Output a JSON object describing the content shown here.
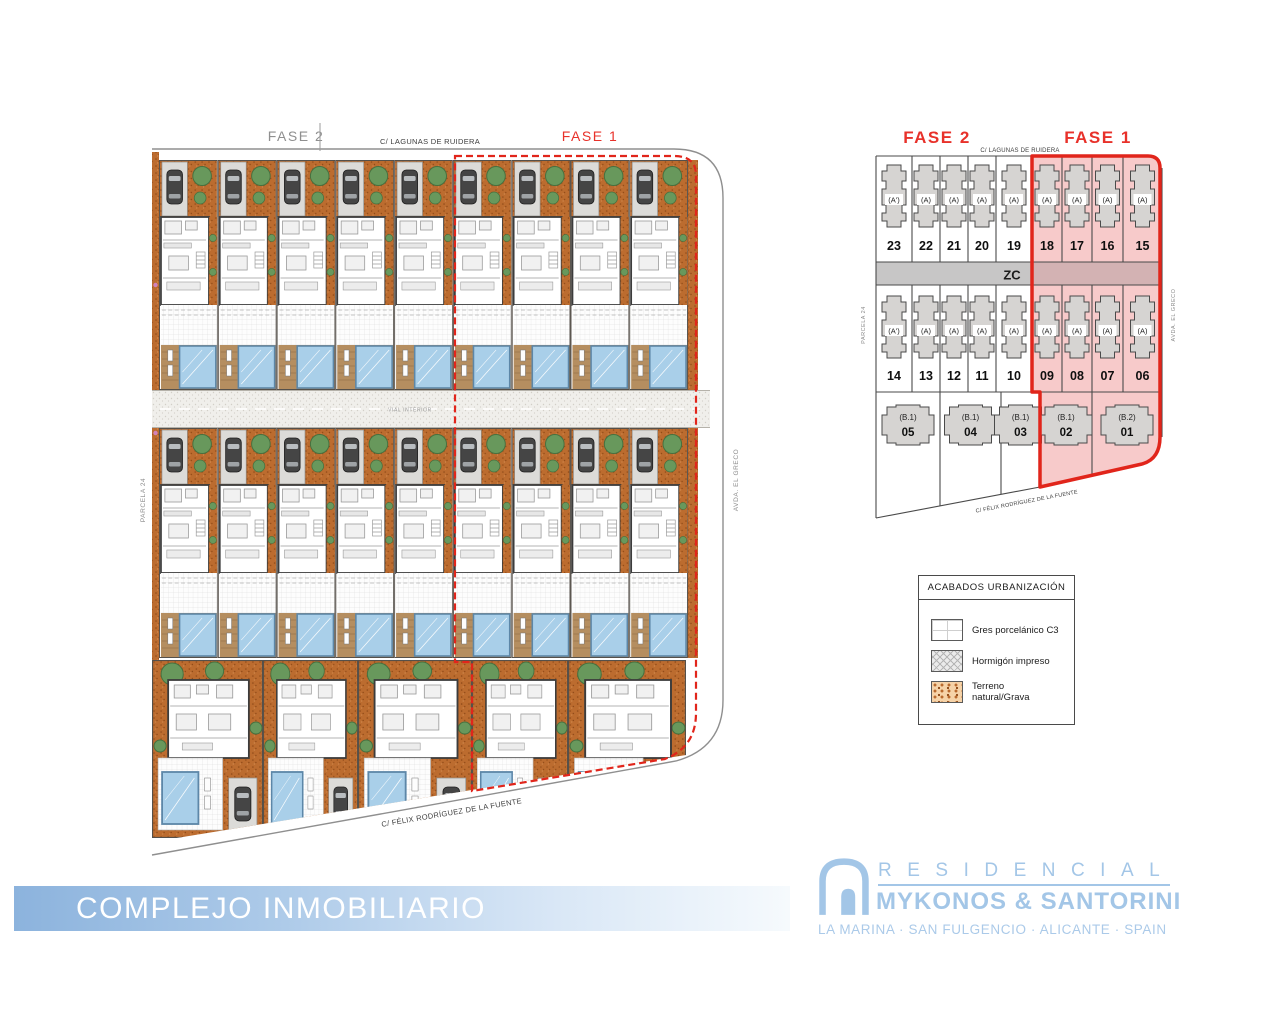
{
  "site_plan": {
    "fase2_label": "FASE 2",
    "fase1_label": "FASE 1",
    "street_top": "C/ LAGUNAS DE RUIDERA",
    "street_bottom": "C/ FÉLIX RODRÍGUEZ DE LA FUENTE",
    "street_right": "AVDA. EL GRECO",
    "parcel_left": "PARCELA 24",
    "road_interior": "VIAL INTERIOR"
  },
  "plot_diagram": {
    "fase2_label": "FASE 2",
    "fase1_label": "FASE 1",
    "street_top": "C/ LAGUNAS DE RUIDERA",
    "street_bottom": "C/ FÉLIX RODRÍGUEZ DE LA FUENTE",
    "street_right": "AVDA. EL GRECO",
    "parcel_left": "PARCELA 24",
    "zc_label": "ZC",
    "row1": [
      {
        "num": "23",
        "type": "(A')",
        "phase": "FASE 2"
      },
      {
        "num": "22",
        "type": "(A)",
        "phase": "FASE 2"
      },
      {
        "num": "21",
        "type": "(A)",
        "phase": "FASE 2"
      },
      {
        "num": "20",
        "type": "(A)",
        "phase": "FASE 2"
      },
      {
        "num": "19",
        "type": "(A)",
        "phase": "FASE 2"
      },
      {
        "num": "18",
        "type": "(A)",
        "phase": "FASE 1"
      },
      {
        "num": "17",
        "type": "(A)",
        "phase": "FASE 1"
      },
      {
        "num": "16",
        "type": "(A)",
        "phase": "FASE 1"
      },
      {
        "num": "15",
        "type": "(A)",
        "phase": "FASE 1"
      }
    ],
    "row2": [
      {
        "num": "14",
        "type": "(A')",
        "phase": "FASE 2"
      },
      {
        "num": "13",
        "type": "(A)",
        "phase": "FASE 2"
      },
      {
        "num": "12",
        "type": "(A)",
        "phase": "FASE 2"
      },
      {
        "num": "11",
        "type": "(A)",
        "phase": "FASE 2"
      },
      {
        "num": "10",
        "type": "(A)",
        "phase": "FASE 2"
      },
      {
        "num": "09",
        "type": "(A)",
        "phase": "FASE 1"
      },
      {
        "num": "08",
        "type": "(A)",
        "phase": "FASE 1"
      },
      {
        "num": "07",
        "type": "(A)",
        "phase": "FASE 1"
      },
      {
        "num": "06",
        "type": "(A)",
        "phase": "FASE 1"
      }
    ],
    "row3": [
      {
        "num": "05",
        "type": "(B.1)",
        "phase": "FASE 2"
      },
      {
        "num": "04",
        "type": "(B.1)",
        "phase": "FASE 2"
      },
      {
        "num": "03",
        "type": "(B.1)",
        "phase": "FASE 2"
      },
      {
        "num": "02",
        "type": "(B.1)",
        "phase": "FASE 1"
      },
      {
        "num": "01",
        "type": "(B.2)",
        "phase": "FASE 1"
      }
    ]
  },
  "legend": {
    "title": "ACABADOS URBANIZACIÓN",
    "items": [
      {
        "label": "Gres porcelánico C3",
        "swatch": "tile-swatch"
      },
      {
        "label": "Hormigón impreso",
        "swatch": "hatch-swatch"
      },
      {
        "label": "Terreno natural/Grava",
        "swatch": "gravel-swatch"
      }
    ]
  },
  "footer": {
    "banner": "COMPLEJO INMOBILIARIO"
  },
  "brand": {
    "residencial": "RESIDENCIAL",
    "name": "MYKONOS & SANTORINI",
    "location": "LA MARINA · SAN FULGENCIO · ALICANTE · SPAIN"
  },
  "colors": {
    "phase_red": "#e1251b",
    "phase_pink": "#f7caca",
    "terracotta": "#bc6c2f",
    "pool_blue": "#a9cfe9",
    "deck_tan": "#b58e60",
    "plot_gray": "#d6d4d2",
    "zc_gray": "#c7c6c6",
    "brand_blue": "#a3c6e7",
    "banner_blue": "#8cb3dd"
  }
}
